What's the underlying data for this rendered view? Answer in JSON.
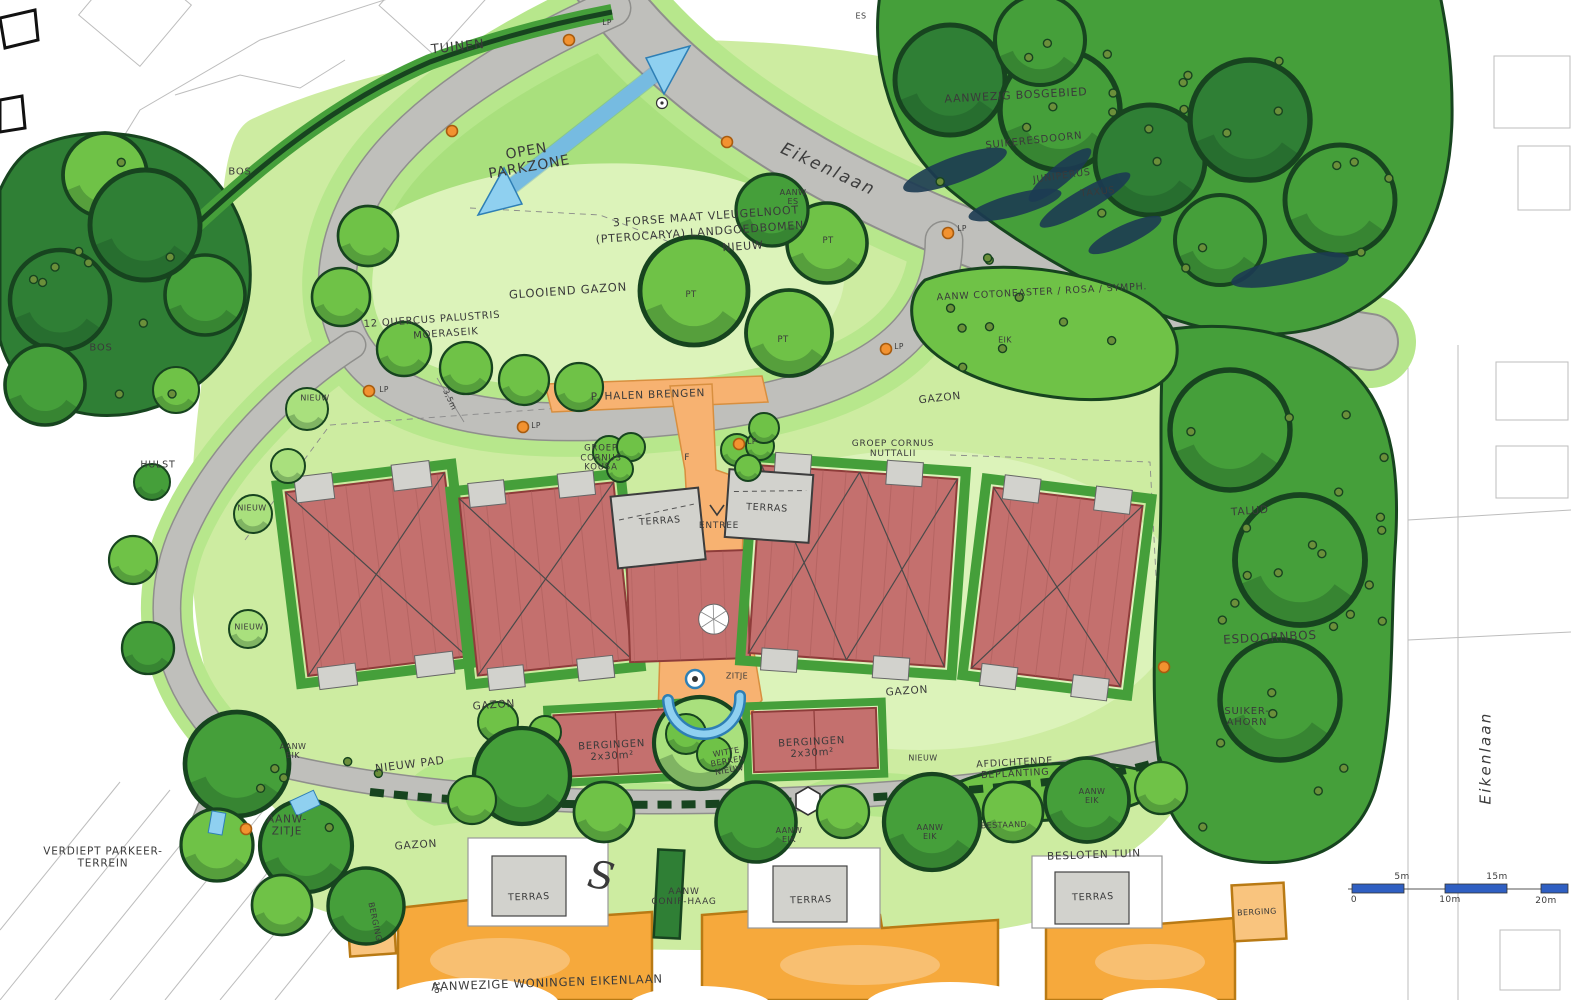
{
  "plan": {
    "type": "landscape masterplan sketch",
    "street": "Eikenlaan",
    "language": "nl"
  },
  "palette": {
    "paper": "#ffffff",
    "ink": "#3a3a3a",
    "sketch": "#bdbdbd",
    "lawn": "#cdeca1",
    "lawn_pale": "#dcf3ba",
    "lawn_bright": "#b7e78c",
    "green_light": "#a9e07d",
    "green_mid": "#6fc247",
    "green_dark": "#459f3a",
    "green_deep": "#2f7f35",
    "green_outline": "#17441f",
    "conifer": "#1c3b52",
    "road": "#bfbfbb",
    "road_edge": "#8f8f8c",
    "path_orange": "#f7b271",
    "path_orange_edge": "#d88f3f",
    "building_red": "#c4706e",
    "building_red_edge": "#8e3c3a",
    "building_red_line": "#a85a58",
    "terras_gray": "#d2d2cd",
    "terras_edge": "#555555",
    "housing_orange": "#f6a93c",
    "housing_orange_light": "#f9c47e",
    "housing_edge": "#b97a14",
    "blue": "#8fd0f0",
    "blue_dark": "#2e7fb5",
    "lamp": "#f29230",
    "lamp_edge": "#a85c0f",
    "scalebar": "#2f5fc2",
    "dot_olive": "#6b8f3a"
  },
  "scale_bar": {
    "ticks": [
      "0",
      "5m",
      "10m",
      "15m",
      "20m"
    ]
  },
  "labels": [
    {
      "t": "TUINEN",
      "x": 458,
      "y": 48,
      "r": -6,
      "s": 13
    },
    {
      "t": "OPEN\nPARKZONE",
      "x": 528,
      "y": 160,
      "r": -10,
      "s": 14
    },
    {
      "t": "Eikenlaan",
      "x": 828,
      "y": 170,
      "r": 25,
      "s": 17,
      "c": "road"
    },
    {
      "t": "Eikenlaan",
      "x": 1486,
      "y": 758,
      "r": -90,
      "s": 15,
      "c": "road"
    },
    {
      "t": "AANWEZIG BOSGEBIED",
      "x": 1016,
      "y": 96,
      "r": -3,
      "s": 11
    },
    {
      "t": "SUIKERESDOORN",
      "x": 1034,
      "y": 141,
      "r": -6,
      "s": 10
    },
    {
      "t": "JUNIPERUS",
      "x": 1062,
      "y": 177,
      "r": -8,
      "s": 9.5
    },
    {
      "t": "TAXUS",
      "x": 1098,
      "y": 193,
      "r": -6,
      "s": 9.5
    },
    {
      "t": "AANW\nES",
      "x": 793,
      "y": 198,
      "r": 0,
      "s": 8,
      "c": "tag"
    },
    {
      "t": "ES",
      "x": 861,
      "y": 17,
      "r": 0,
      "s": 8,
      "c": "tag"
    },
    {
      "t": "3 FORSE MAAT VLEUGELNOOT",
      "x": 706,
      "y": 217,
      "r": -4,
      "s": 11
    },
    {
      "t": "(PTEROCARYA) LANDGOEDBOMEN",
      "x": 700,
      "y": 233,
      "r": -4,
      "s": 11
    },
    {
      "t": "NIEUW",
      "x": 743,
      "y": 247,
      "r": -4,
      "s": 11
    },
    {
      "t": "GLOOIEND GAZON",
      "x": 568,
      "y": 291,
      "r": -4,
      "s": 11.5
    },
    {
      "t": "BOS",
      "x": 240,
      "y": 172,
      "r": 0,
      "s": 10
    },
    {
      "t": "BOS",
      "x": 101,
      "y": 348,
      "r": 0,
      "s": 10
    },
    {
      "t": "12 QUERCUS PALUSTRIS",
      "x": 432,
      "y": 320,
      "r": -4,
      "s": 10
    },
    {
      "t": "MOERASEIK",
      "x": 446,
      "y": 334,
      "r": -4,
      "s": 10
    },
    {
      "t": "AANW COTONEASTER / ROSA / SYMPH.",
      "x": 1042,
      "y": 293,
      "r": -3,
      "s": 9.5
    },
    {
      "t": "EIK",
      "x": 1005,
      "y": 341,
      "r": 0,
      "s": 8,
      "c": "tag"
    },
    {
      "t": "GAZON",
      "x": 940,
      "y": 399,
      "r": -6,
      "s": 10.5
    },
    {
      "t": "P. HALEN BRENGEN",
      "x": 648,
      "y": 396,
      "r": -2,
      "s": 10.5
    },
    {
      "t": "3,5m",
      "x": 449,
      "y": 400,
      "r": 65,
      "s": 8,
      "c": "tag"
    },
    {
      "t": "GROEP\nCORNUS\nKOUSA",
      "x": 601,
      "y": 459,
      "r": 0,
      "s": 8.5
    },
    {
      "t": "GROEP CORNUS\nNUTTALII",
      "x": 893,
      "y": 449,
      "r": 0,
      "s": 9
    },
    {
      "t": "HULST",
      "x": 158,
      "y": 466,
      "r": 0,
      "s": 9.5
    },
    {
      "t": "NIEUW",
      "x": 315,
      "y": 399,
      "r": 0,
      "s": 8,
      "c": "tag"
    },
    {
      "t": "NIEUW",
      "x": 252,
      "y": 509,
      "r": 0,
      "s": 8,
      "c": "tag"
    },
    {
      "t": "NIEUW",
      "x": 249,
      "y": 628,
      "r": 0,
      "s": 8,
      "c": "tag"
    },
    {
      "t": "TERRAS",
      "x": 660,
      "y": 522,
      "r": -4,
      "s": 9.5
    },
    {
      "t": "TERRAS",
      "x": 767,
      "y": 509,
      "r": 3,
      "s": 9.5
    },
    {
      "t": "ENTREE",
      "x": 719,
      "y": 526,
      "r": 0,
      "s": 9
    },
    {
      "t": "F",
      "x": 687,
      "y": 458,
      "r": 0,
      "s": 9,
      "c": "tag"
    },
    {
      "t": "TALUD",
      "x": 1250,
      "y": 512,
      "r": -4,
      "s": 10.5
    },
    {
      "t": "ESDOORNBOS",
      "x": 1270,
      "y": 638,
      "r": -3,
      "s": 12
    },
    {
      "t": "SUIKER-\nAHORN",
      "x": 1247,
      "y": 717,
      "r": 0,
      "s": 10
    },
    {
      "t": "GAZON",
      "x": 494,
      "y": 706,
      "r": -4,
      "s": 10.5
    },
    {
      "t": "GAZON",
      "x": 907,
      "y": 692,
      "r": -4,
      "s": 10.5
    },
    {
      "t": "ZITJE",
      "x": 737,
      "y": 677,
      "r": 0,
      "s": 8,
      "c": "tag"
    },
    {
      "t": "BERGINGEN\n2x30m²",
      "x": 612,
      "y": 751,
      "r": -3,
      "s": 10
    },
    {
      "t": "BERGINGEN\n2x30m²",
      "x": 812,
      "y": 748,
      "r": -3,
      "s": 10
    },
    {
      "t": "WITTE\nBERKEN\nNIEUW",
      "x": 728,
      "y": 762,
      "r": -10,
      "s": 8,
      "c": "tag"
    },
    {
      "t": "NIEUW PAD",
      "x": 410,
      "y": 765,
      "r": -7,
      "s": 11
    },
    {
      "t": "NIEUW",
      "x": 923,
      "y": 759,
      "r": 0,
      "s": 8,
      "c": "tag"
    },
    {
      "t": "AFDICHTENDE\nBEPLANTING",
      "x": 1015,
      "y": 769,
      "r": -3,
      "s": 9.5
    },
    {
      "t": "AANW\nEIK",
      "x": 293,
      "y": 752,
      "r": 0,
      "s": 8,
      "c": "tag"
    },
    {
      "t": "AANW-\nZITJE",
      "x": 287,
      "y": 826,
      "r": 0,
      "s": 10.5
    },
    {
      "t": "VERDIEPT PARKEER-\nTERREIN",
      "x": 103,
      "y": 858,
      "r": 0,
      "s": 10.5
    },
    {
      "t": "AANW\nEIK",
      "x": 930,
      "y": 833,
      "r": 0,
      "s": 8,
      "c": "tag"
    },
    {
      "t": "BESTAAND",
      "x": 1004,
      "y": 826,
      "r": -2,
      "s": 8,
      "c": "tag"
    },
    {
      "t": "AANW\nEIK",
      "x": 1092,
      "y": 797,
      "r": 0,
      "s": 8,
      "c": "tag"
    },
    {
      "t": "AANW\nEIK",
      "x": 789,
      "y": 836,
      "r": 0,
      "s": 8,
      "c": "tag"
    },
    {
      "t": "BESLOTEN TUIN",
      "x": 1094,
      "y": 856,
      "r": -2,
      "s": 10.5
    },
    {
      "t": "GAZON",
      "x": 416,
      "y": 846,
      "r": -4,
      "s": 10.5
    },
    {
      "t": "TERRAS",
      "x": 529,
      "y": 898,
      "r": -2,
      "s": 9.5
    },
    {
      "t": "AANW\nCONIF-HAAG",
      "x": 684,
      "y": 897,
      "r": 0,
      "s": 9
    },
    {
      "t": "TERRAS",
      "x": 811,
      "y": 901,
      "r": -2,
      "s": 9.5
    },
    {
      "t": "TERRAS",
      "x": 1093,
      "y": 898,
      "r": -2,
      "s": 9.5
    },
    {
      "t": "BERGING",
      "x": 374,
      "y": 922,
      "r": 78,
      "s": 8,
      "c": "tag"
    },
    {
      "t": "BERGING",
      "x": 1257,
      "y": 913,
      "r": -3,
      "s": 8,
      "c": "tag"
    },
    {
      "t": "AANWEZIGE WONINGEN EIKENLAAN",
      "x": 547,
      "y": 983,
      "r": -2,
      "s": 11.5
    },
    {
      "t": "16",
      "x": 436,
      "y": 988,
      "r": 78,
      "s": 9,
      "c": "tag"
    },
    {
      "t": "0",
      "x": 1354,
      "y": 900,
      "r": 0,
      "s": 9,
      "c": "tag"
    },
    {
      "t": "5m",
      "x": 1402,
      "y": 877,
      "r": 0,
      "s": 9,
      "c": "tag"
    },
    {
      "t": "10m",
      "x": 1450,
      "y": 900,
      "r": 0,
      "s": 9,
      "c": "tag"
    },
    {
      "t": "15m",
      "x": 1497,
      "y": 877,
      "r": 0,
      "s": 9,
      "c": "tag"
    },
    {
      "t": "20m",
      "x": 1546,
      "y": 901,
      "r": 0,
      "s": 9,
      "c": "tag"
    },
    {
      "t": "LP",
      "x": 607,
      "y": 23,
      "r": 0,
      "s": 7.5,
      "c": "tag"
    },
    {
      "t": "LP",
      "x": 962,
      "y": 229,
      "r": 0,
      "s": 7.5,
      "c": "tag"
    },
    {
      "t": "LP",
      "x": 899,
      "y": 347,
      "r": 0,
      "s": 7.5,
      "c": "tag"
    },
    {
      "t": "LP",
      "x": 752,
      "y": 442,
      "r": 0,
      "s": 7.5,
      "c": "tag"
    },
    {
      "t": "LP",
      "x": 536,
      "y": 426,
      "r": 0,
      "s": 7.5,
      "c": "tag"
    },
    {
      "t": "LP",
      "x": 384,
      "y": 390,
      "r": 0,
      "s": 7.5,
      "c": "tag"
    },
    {
      "t": "PT",
      "x": 691,
      "y": 296,
      "r": 0,
      "s": 8.5,
      "c": "tag"
    },
    {
      "t": "PT",
      "x": 783,
      "y": 341,
      "r": 0,
      "s": 8.5,
      "c": "tag"
    },
    {
      "t": "PT",
      "x": 828,
      "y": 242,
      "r": 0,
      "s": 8.5,
      "c": "tag"
    },
    {
      "t": "S",
      "x": 601,
      "y": 876,
      "r": 10,
      "s": 38,
      "c": "serif"
    }
  ],
  "trees": [
    [
      368,
      236,
      30,
      "M"
    ],
    [
      341,
      297,
      29,
      "M"
    ],
    [
      404,
      349,
      27,
      "M"
    ],
    [
      466,
      368,
      26,
      "M"
    ],
    [
      524,
      380,
      25,
      "M"
    ],
    [
      579,
      387,
      24,
      "M"
    ],
    [
      307,
      409,
      21,
      "L"
    ],
    [
      288,
      466,
      17,
      "L"
    ],
    [
      253,
      514,
      19,
      "L"
    ],
    [
      248,
      629,
      19,
      "L"
    ],
    [
      176,
      390,
      23,
      "M"
    ],
    [
      152,
      482,
      18,
      "D"
    ],
    [
      133,
      560,
      24,
      "M"
    ],
    [
      148,
      648,
      26,
      "D"
    ],
    [
      694,
      291,
      54,
      "M"
    ],
    [
      789,
      333,
      43,
      "M"
    ],
    [
      827,
      243,
      40,
      "M"
    ],
    [
      772,
      210,
      36,
      "D"
    ],
    [
      609,
      452,
      16,
      "M"
    ],
    [
      631,
      447,
      14,
      "M"
    ],
    [
      620,
      469,
      13,
      "M"
    ],
    [
      737,
      450,
      16,
      "M"
    ],
    [
      760,
      446,
      14,
      "M"
    ],
    [
      748,
      468,
      13,
      "M"
    ],
    [
      764,
      428,
      15,
      "M"
    ],
    [
      700,
      743,
      46,
      "L"
    ],
    [
      686,
      734,
      20,
      "M"
    ],
    [
      714,
      754,
      17,
      "M"
    ],
    [
      498,
      722,
      20,
      "M"
    ],
    [
      545,
      732,
      16,
      "M"
    ],
    [
      522,
      776,
      48,
      "D"
    ],
    [
      604,
      812,
      30,
      "M"
    ],
    [
      756,
      822,
      40,
      "D"
    ],
    [
      843,
      812,
      26,
      "M"
    ],
    [
      932,
      822,
      48,
      "D"
    ],
    [
      1013,
      812,
      30,
      "M"
    ],
    [
      1087,
      800,
      42,
      "D"
    ],
    [
      1161,
      788,
      26,
      "M"
    ],
    [
      472,
      800,
      24,
      "M"
    ],
    [
      237,
      764,
      52,
      "D"
    ],
    [
      306,
      846,
      46,
      "D"
    ],
    [
      217,
      845,
      36,
      "M"
    ],
    [
      366,
      906,
      38,
      "D"
    ],
    [
      282,
      905,
      30,
      "M"
    ],
    [
      105,
      175,
      42,
      "M"
    ],
    [
      205,
      295,
      40,
      "D"
    ],
    [
      60,
      300,
      50,
      "P"
    ],
    [
      145,
      225,
      55,
      "P"
    ],
    [
      45,
      385,
      40,
      "D"
    ],
    [
      950,
      80,
      55,
      "P"
    ],
    [
      1060,
      110,
      60,
      "D"
    ],
    [
      1150,
      160,
      55,
      "P"
    ],
    [
      1040,
      40,
      45,
      "D"
    ],
    [
      1250,
      120,
      60,
      "P"
    ],
    [
      1340,
      200,
      55,
      "D"
    ],
    [
      1230,
      430,
      60,
      "D"
    ],
    [
      1300,
      560,
      65,
      "D"
    ],
    [
      1280,
      700,
      60,
      "D"
    ],
    [
      1220,
      240,
      45,
      "D"
    ]
  ],
  "lamps": [
    [
      569,
      40
    ],
    [
      948,
      233
    ],
    [
      886,
      349
    ],
    [
      739,
      444
    ],
    [
      523,
      427
    ],
    [
      369,
      391
    ],
    [
      452,
      131
    ],
    [
      727,
      142
    ],
    [
      1164,
      667
    ],
    [
      246,
      829
    ]
  ],
  "survey_points": [
    [
      662,
      103
    ]
  ]
}
